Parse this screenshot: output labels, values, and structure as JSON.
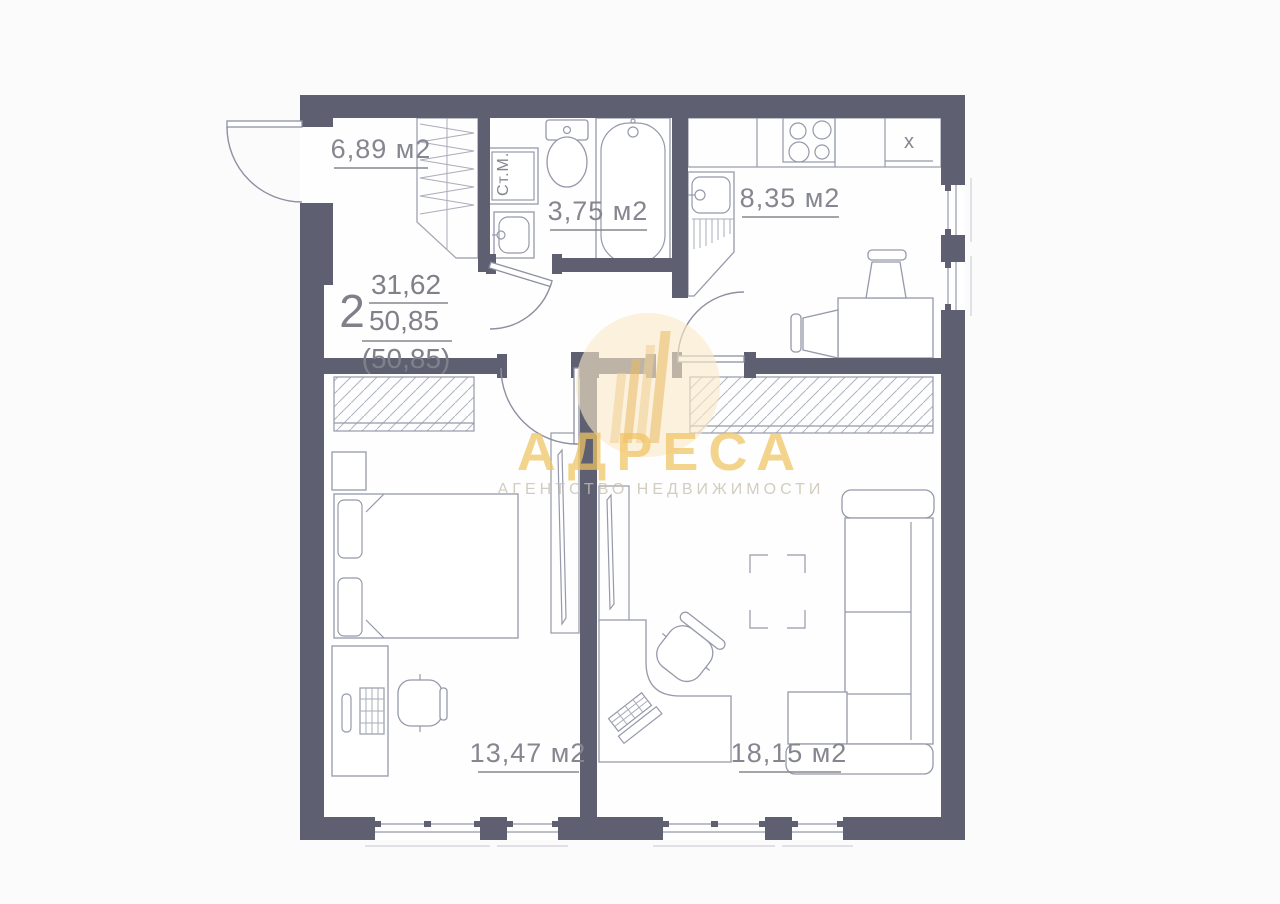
{
  "floor_plan": {
    "unit": {
      "rooms_count": "2",
      "area_living": "31,62",
      "area_total": "50,85",
      "area_total_alt": "(50,85)"
    },
    "rooms": [
      {
        "name": "hallway",
        "area": "6,89 м2"
      },
      {
        "name": "bathroom",
        "area": "3,75 м2"
      },
      {
        "name": "kitchen",
        "area": "8,35 м2"
      },
      {
        "name": "bedroom",
        "area": "13,47 м2"
      },
      {
        "name": "living-room",
        "area": "18,15 м2"
      }
    ],
    "labels": {
      "washing_machine": "Ст.М.",
      "kitchen_unit": "x"
    },
    "colors": {
      "wall": "#5e6072",
      "fixture_stroke": "#9599a9",
      "label_text": "#85868f",
      "watermark_gold": "#f0c463",
      "watermark_circle": "#f8e9c8"
    }
  },
  "watermark": {
    "title": "АДРЕСА",
    "subtitle": "АГЕНТСТВО НЕДВИЖИМОСТИ"
  }
}
